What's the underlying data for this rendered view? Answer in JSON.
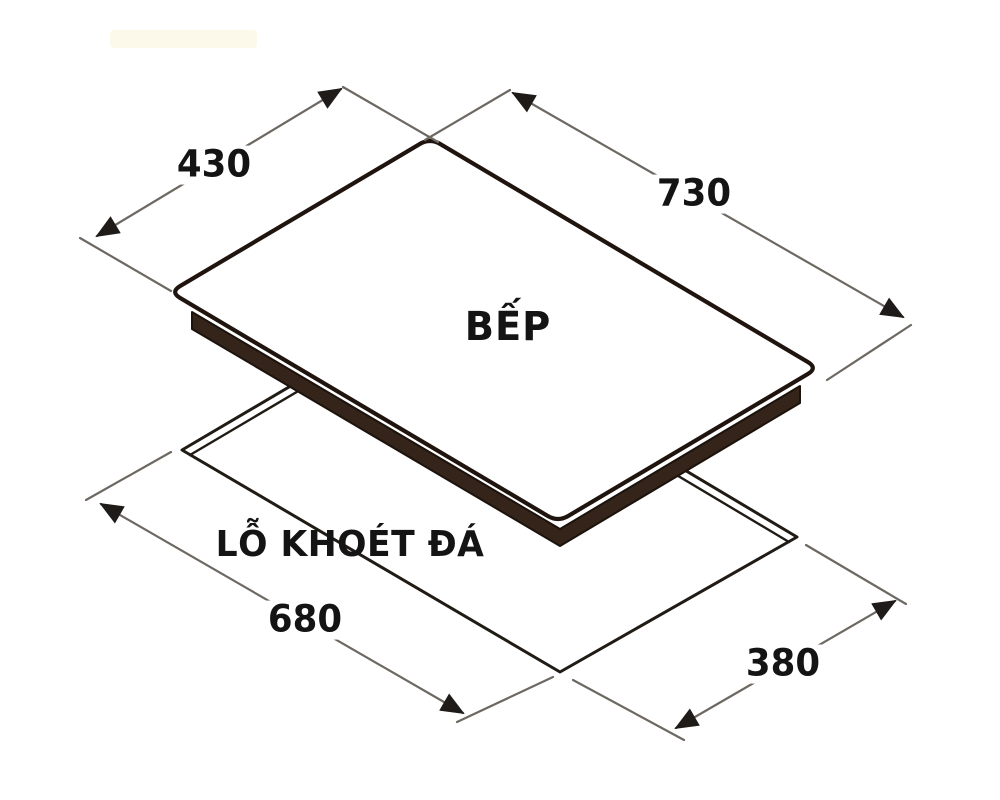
{
  "diagram": {
    "product_label": "BẾP",
    "cutout_label": "LỖ KHOÉT ĐÁ",
    "dims": {
      "cooktop_depth": "430",
      "cooktop_width": "730",
      "cutout_width": "680",
      "cutout_depth": "380"
    },
    "colors": {
      "glass_outline": "#20150e",
      "body_band": "#35241a",
      "cutout_line": "#211b16",
      "dimension_line": "#6e6862",
      "arrowhead": "#1f1b18",
      "text": "#141414",
      "watermark": "#fcf8ea",
      "background": "#ffffff"
    }
  }
}
